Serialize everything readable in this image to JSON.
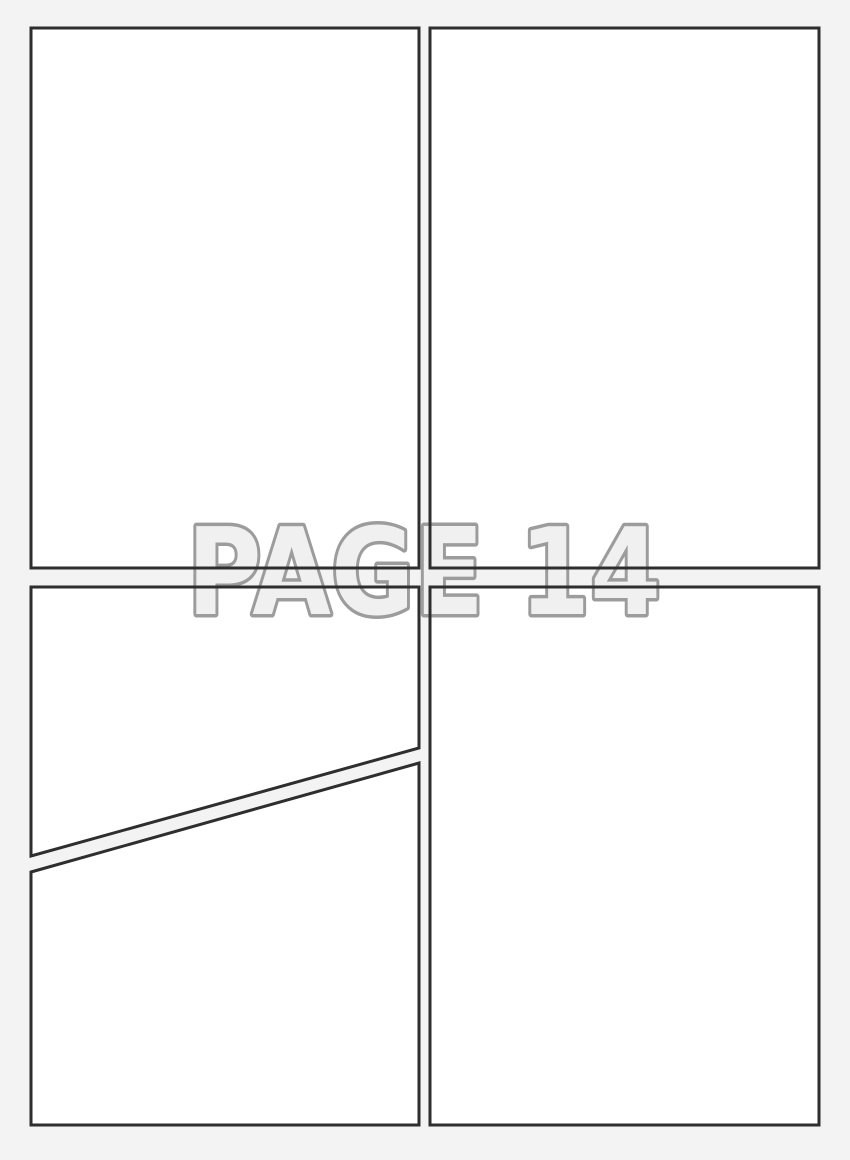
{
  "watermark": {
    "label": "PAGE 14"
  },
  "colors": {
    "background": "#f3f3f4",
    "panel_fill": "#ffffff",
    "panel_border": "#2e2e2e",
    "watermark_fill": "#f0f0f0",
    "watermark_outline": "#9c9c9c"
  }
}
